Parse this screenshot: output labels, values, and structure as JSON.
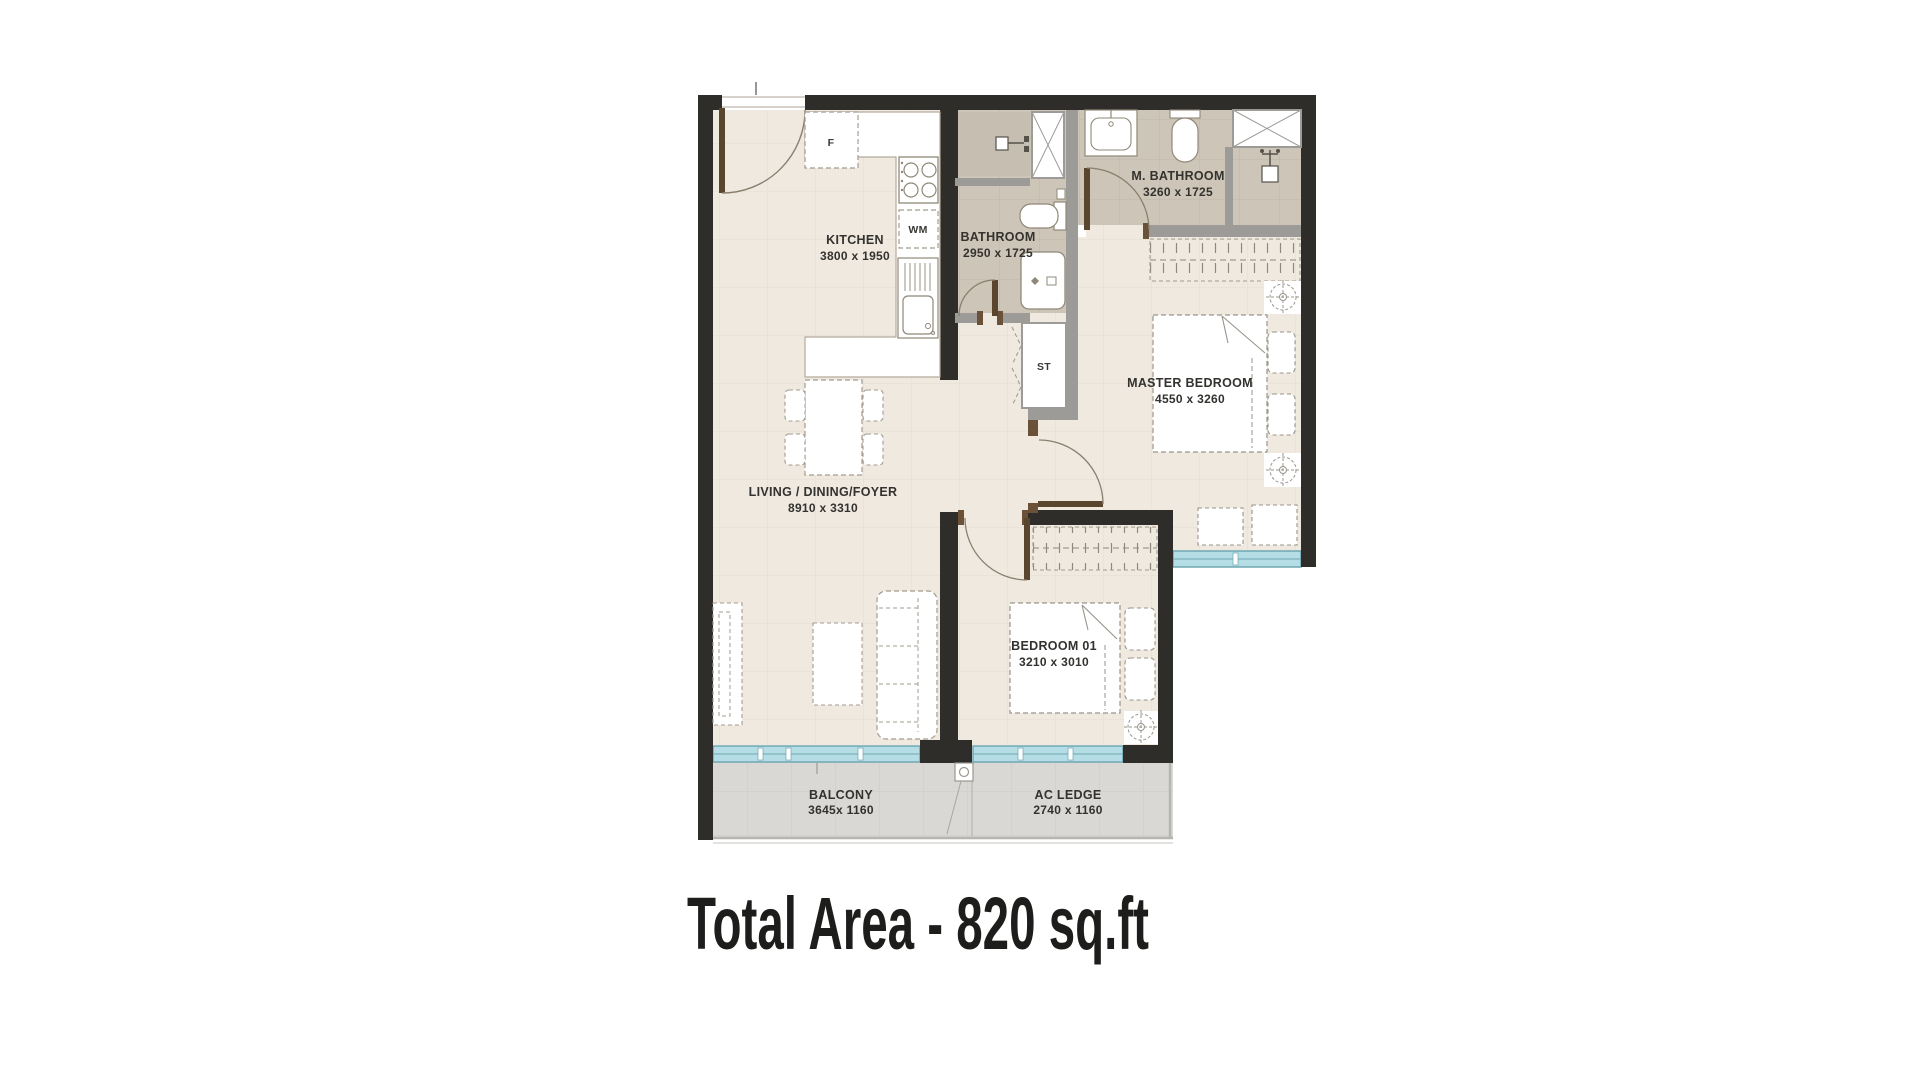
{
  "title": {
    "text": "Total Area - 820 sq.ft"
  },
  "rooms": {
    "kitchen": {
      "name": "KITCHEN",
      "dims": "3800 x 1950"
    },
    "bathroom": {
      "name": "BATHROOM",
      "dims": "2950 x 1725"
    },
    "master_bathroom": {
      "name": "M. BATHROOM",
      "dims": "3260 x 1725"
    },
    "master_bedroom": {
      "name": "MASTER BEDROOM",
      "dims": "4550 x 3260"
    },
    "living": {
      "name": "LIVING / DINING/FOYER",
      "dims": "8910 x 3310"
    },
    "bedroom_01": {
      "name": "BEDROOM 01",
      "dims": "3210 x 3010"
    },
    "balcony": {
      "name": "BALCONY",
      "dims": "3645x 1160"
    },
    "ac_ledge": {
      "name": "AC LEDGE",
      "dims": "2740 x 1160"
    }
  },
  "fixtures": {
    "fridge": "F",
    "washing_machine": "WM",
    "storage": "ST"
  },
  "colors": {
    "wall": "#2e2d2a",
    "partition": "#9c9b97",
    "floor": "#efe9e0",
    "bath_floor": "#cdc5b8",
    "balcony_floor": "#d9d8d5",
    "window": "#b5dde5",
    "window_frame": "#6fa7b2",
    "door": "#5a452f",
    "text": "#33322e"
  }
}
